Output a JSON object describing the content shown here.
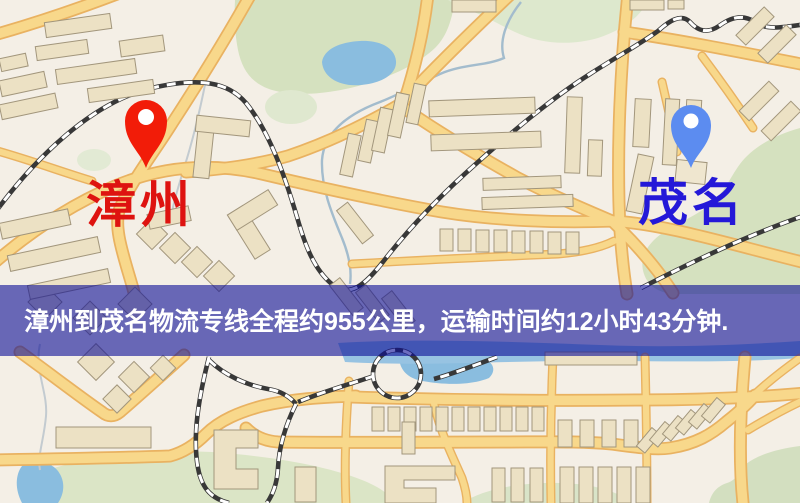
{
  "map": {
    "origin": {
      "name": "漳州",
      "label_color": "#de1310",
      "pin_color": "#f21c08"
    },
    "destination": {
      "name": "茂名",
      "label_color": "#2418d8",
      "pin_color": "#5c8cf0"
    }
  },
  "banner": {
    "text": "漳州到茂名物流专线全程约955公里，运输时间约12小时43分钟.",
    "text_color": "#ffffff",
    "overlay_color": "rgba(10,12,150,0.60)"
  },
  "palette": {
    "land": "#f4efe6",
    "park": "#d5e1bf",
    "water": "#8abddf",
    "road_fill": "#f8d88b",
    "road_casing": "#e9b261",
    "building": "#ece1c4",
    "railway": "#383838"
  }
}
